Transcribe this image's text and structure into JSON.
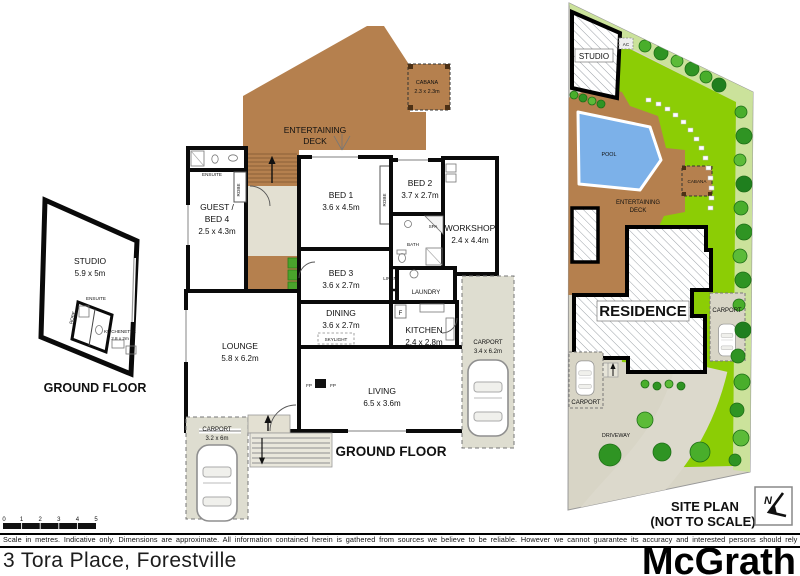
{
  "footer": {
    "address": "3 Tora Place, Forestville",
    "brand": "McGrath",
    "disclaimer": "Scale in metres. Indicative only. Dimensions are approximate. All information contained herein is gathered from sources we believe to be reliable. However we cannot guarantee its accuracy and interested persons should rely on their own enquiries"
  },
  "scale_bar": {
    "ticks": [
      "0",
      "1",
      "2",
      "3",
      "4",
      "5"
    ]
  },
  "studio_plan": {
    "title": "GROUND FLOOR",
    "studio_name": "STUDIO",
    "studio_dims": "5.9 x 5m",
    "ensuite": "ENSUITE",
    "robe": "ROBE",
    "kitchenette_name": "KITCHENETTE",
    "kitchenette_dims": "2.8 x 2m"
  },
  "main_plan": {
    "title": "GROUND FLOOR",
    "cabana_name": "CABANA",
    "cabana_dims": "2.3 x 2.3m",
    "deck_l1": "ENTERTAINING",
    "deck_l2": "DECK",
    "guest_l1": "GUEST /",
    "guest_l2": "BED 4",
    "guest_dims": "2.5 x 4.3m",
    "ensuite": "ENSUITE",
    "robe": "ROBE",
    "bed1_name": "BED 1",
    "bed1_dims": "3.6 x 4.5m",
    "bed2_name": "BED 2",
    "bed2_dims": "3.7 x 2.7m",
    "bed3_name": "BED 3",
    "bed3_dims": "3.6 x 2.7m",
    "workshop_name": "WORKSHOP",
    "workshop_dims": "2.4 x 4.4m",
    "spa": "SPA",
    "bath": "BATH",
    "linen": "LINEN",
    "laundry": "LAUNDRY",
    "dining_name": "DINING",
    "dining_dims": "3.6 x 2.7m",
    "skylight": "SKYLIGHT",
    "kitchen_name": "KITCHEN",
    "kitchen_dims": "2.4 x 2.8m",
    "fridge": "F",
    "lounge_name": "LOUNGE",
    "lounge_dims": "5.8 x 6.2m",
    "living_name": "LIVING",
    "living_dims": "6.5 x 3.6m",
    "fp_left": "FP",
    "fp_right": "FP",
    "carport_right_name": "CARPORT",
    "carport_right_dims": "3.4 x 6.2m",
    "carport_left_name": "CARPORT",
    "carport_left_dims": "3.2 x 6m"
  },
  "site_plan": {
    "title": "SITE PLAN",
    "subtitle": "(NOT TO SCALE)",
    "studio": "STUDIO",
    "ac": "AC",
    "pool": "POOL",
    "cabana": "CABANA",
    "deck_l1": "ENTERTAINING",
    "deck_l2": "DECK",
    "residence": "RESIDENCE",
    "carport_right": "CARPORT",
    "carport_left": "CARPORT",
    "driveway": "DRIVEWAY",
    "north": "N"
  },
  "colors": {
    "wall": "#0a0a0a",
    "deck": "#b5804e",
    "hall": "#e3e0d2",
    "carport": "#deddd0",
    "lawn": "#8ccd05",
    "garden_band": "#cbe29b",
    "ground": "#d8d5c6",
    "driveway": "#dcd9cc",
    "pool": "#7cb1e9"
  }
}
